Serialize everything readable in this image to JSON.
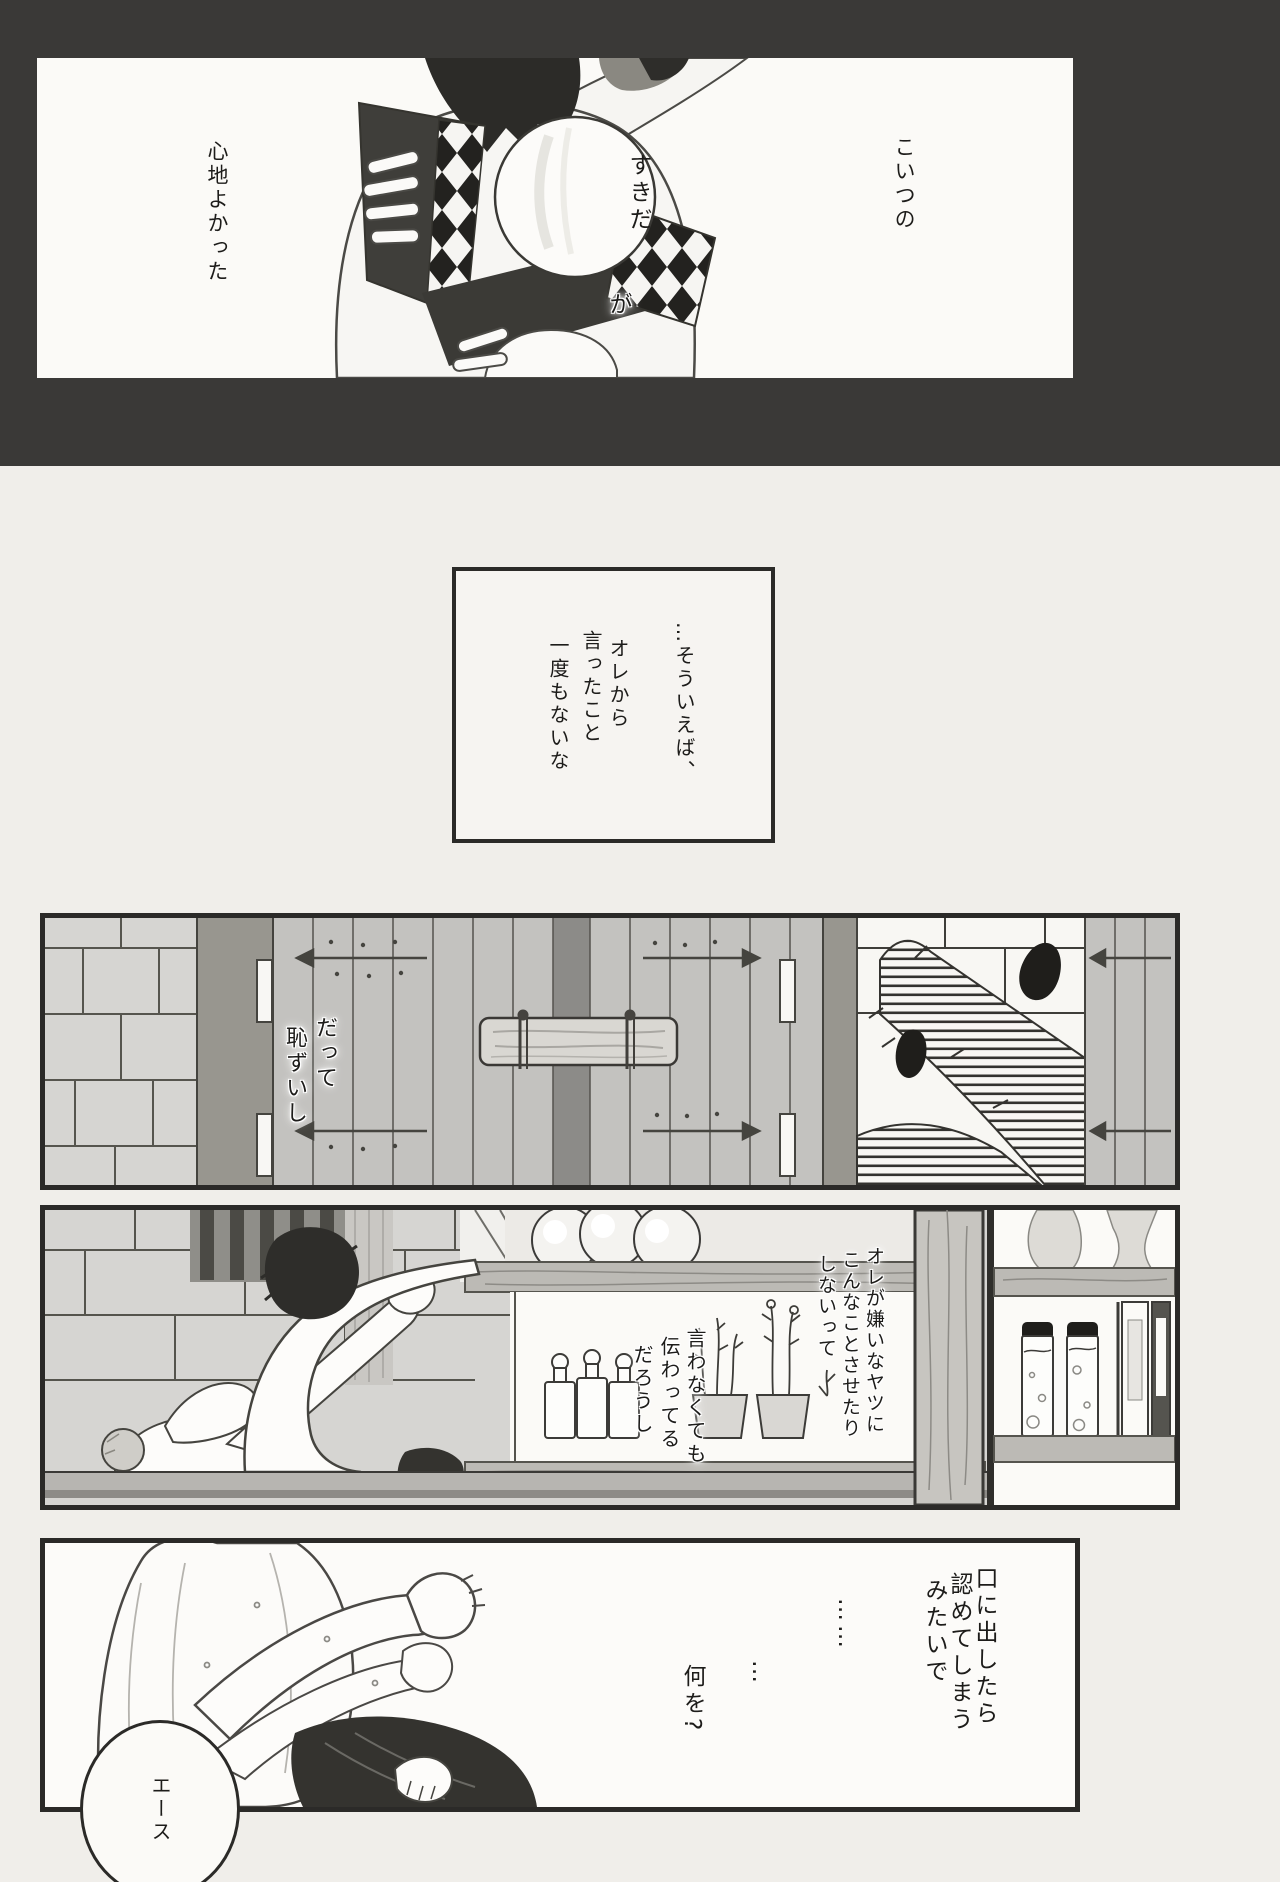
{
  "theme": {
    "page_bg": "#f0eeea",
    "band": "#3a3937",
    "panel_bg": "#fbfaf7",
    "border": "#2b2a28",
    "ink": "#1d1c1a",
    "door": "#c3c2bf",
    "pillar": "#98968f",
    "brick": "#d6d5d2",
    "wood": "#bcbab5",
    "floor": "#b7b5b1"
  },
  "panels": {
    "opening": {
      "narration_right": "こいつの",
      "bubble_word": "すきだ",
      "bubble_particle": "が",
      "narration_left": "心地よかった"
    },
    "monologue_box": {
      "lines": [
        "…そういえば、",
        "オレから",
        "言ったこと",
        "一度もないな"
      ]
    },
    "door_scene": {
      "dialogue": [
        "だって",
        "恥ずいし"
      ]
    },
    "bar_scene": {
      "speech_right": [
        "オレが嫌いなヤツに",
        "こんなことさせたり",
        "しないって"
      ],
      "speech_left": [
        "言わなくても",
        "伝わってる",
        "だろうし"
      ]
    },
    "closing_scene": {
      "monologue": [
        "口に出したら",
        "認めてしまう",
        "みたいで"
      ],
      "pause_long": "……",
      "pause_short": "…",
      "question": "何を?",
      "name_call": "エース"
    }
  }
}
